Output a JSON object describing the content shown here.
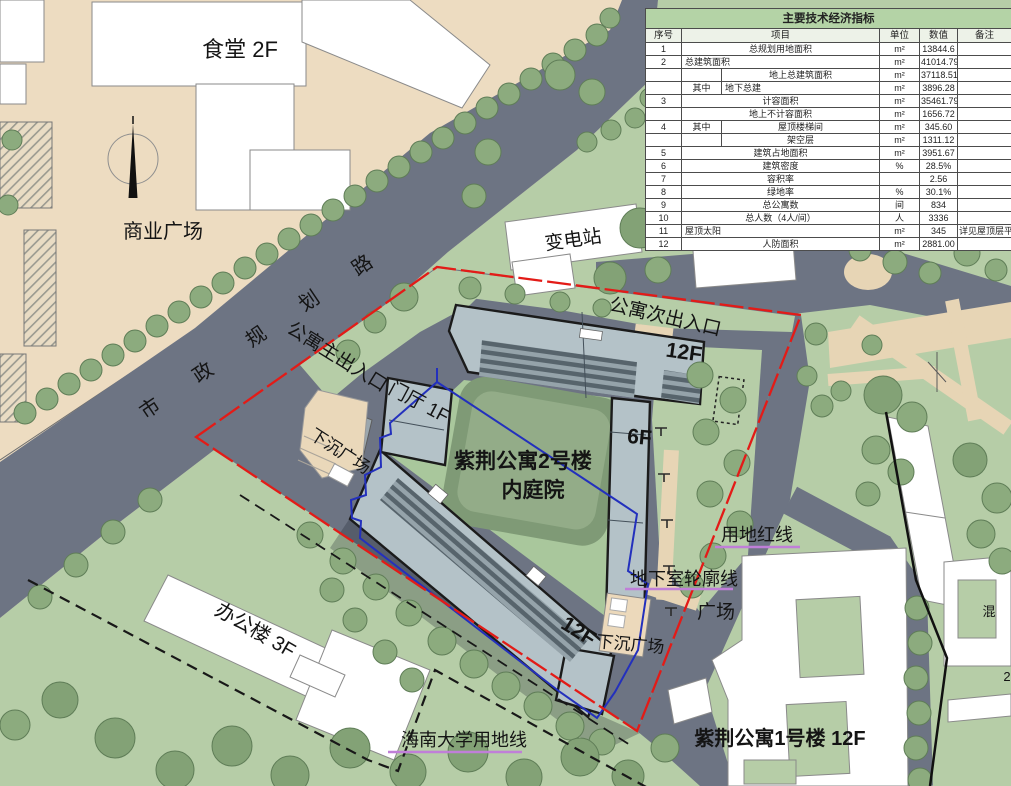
{
  "table": {
    "title": "主要技术经济指标",
    "columns": [
      "序号",
      "项目",
      "单位",
      "数值",
      "备注"
    ],
    "col_widths": [
      36,
      40,
      158,
      40,
      38,
      54
    ],
    "rows": [
      [
        "1",
        {
          "t": "总规划用地面积",
          "cs": 2
        },
        "m²",
        "13844.6",
        ""
      ],
      [
        "2",
        {
          "t": "总建筑面积",
          "cs": 2,
          "al": "l"
        },
        "m²",
        "41014.79",
        ""
      ],
      [
        "",
        "",
        "地上总建筑面积",
        "m²",
        "37118.51",
        ""
      ],
      [
        "",
        "其中",
        {
          "t": "地下总建",
          "al": "l"
        },
        "m²",
        "3896.28",
        ""
      ],
      [
        "3",
        {
          "t": "计容面积",
          "cs": 2
        },
        "m²",
        "35461.79",
        ""
      ],
      [
        "",
        {
          "t": "地上不计容面积",
          "cs": 2
        },
        "m²",
        "1656.72",
        ""
      ],
      [
        "4",
        "其中",
        "屋顶楼梯间",
        "m²",
        "345.60",
        ""
      ],
      [
        "",
        "",
        "架空层",
        "m²",
        "1311.12",
        ""
      ],
      [
        "5",
        {
          "t": "建筑占地面积",
          "cs": 2
        },
        "m²",
        "3951.67",
        ""
      ],
      [
        "6",
        {
          "t": "建筑密度",
          "cs": 2
        },
        "%",
        "28.5%",
        ""
      ],
      [
        "7",
        {
          "t": "容积率",
          "cs": 2
        },
        "",
        "2.56",
        ""
      ],
      [
        "8",
        {
          "t": "绿地率",
          "cs": 2
        },
        "%",
        "30.1%",
        ""
      ],
      [
        "9",
        {
          "t": "总公寓数",
          "cs": 2
        },
        "间",
        "834",
        ""
      ],
      [
        "10",
        {
          "t": "总人数（4人/间）",
          "cs": 2
        },
        "人",
        "3336",
        ""
      ],
      [
        "11",
        {
          "t": "屋顶太阳",
          "cs": 2,
          "al": "l"
        },
        "m²",
        "345",
        "详见屋顶层平面图"
      ],
      [
        "12",
        {
          "t": "人防面积",
          "cs": 2
        },
        "m²",
        "2881.00",
        ""
      ]
    ]
  },
  "labels": [
    {
      "id": "canteen",
      "t": "食堂 2F",
      "x": 240,
      "y": 57,
      "s": 22
    },
    {
      "id": "commercial-plaza",
      "t": "商业广场",
      "x": 163,
      "y": 238,
      "s": 20
    },
    {
      "id": "substation",
      "t": "变电站",
      "x": 574,
      "y": 246,
      "r": -8,
      "s": 19
    },
    {
      "id": "road-name",
      "t": "市政规划路",
      "x": 278,
      "y": 330,
      "r": -34,
      "s": 20,
      "ls": 44
    },
    {
      "id": "main-entrance",
      "t": "公寓主出入口",
      "x": 334,
      "y": 362,
      "r": 32,
      "s": 19
    },
    {
      "id": "lobby",
      "t": "门厅 1F",
      "x": 416,
      "y": 408,
      "r": 28,
      "s": 19
    },
    {
      "id": "sunken-plaza-west",
      "t": "下沉广场",
      "x": 337,
      "y": 456,
      "r": 33,
      "s": 17
    },
    {
      "id": "secondary-entrance",
      "t": "公寓次出入口",
      "x": 664,
      "y": 323,
      "r": 13,
      "s": 19
    },
    {
      "id": "floors-12f-ne",
      "t": "12F",
      "x": 683,
      "y": 359,
      "r": 8,
      "s": 21,
      "w": 600
    },
    {
      "id": "floors-6f",
      "t": "6F",
      "x": 639,
      "y": 444,
      "r": 5,
      "s": 21,
      "w": 600
    },
    {
      "id": "building2-name",
      "t": "紫荆公寓2号楼",
      "x": 523,
      "y": 468,
      "s": 21,
      "w": 600
    },
    {
      "id": "building2-courtyard",
      "t": "内庭院",
      "x": 533,
      "y": 497,
      "s": 21,
      "w": 600
    },
    {
      "id": "floors-12f-se",
      "t": "12F",
      "x": 575,
      "y": 637,
      "r": 32,
      "s": 21,
      "w": 600
    },
    {
      "id": "sunken-plaza-se",
      "t": "下沉广场",
      "x": 630,
      "y": 650,
      "r": 5,
      "s": 17
    },
    {
      "id": "red-line-label",
      "t": "用地红线",
      "x": 757,
      "y": 541,
      "s": 18
    },
    {
      "id": "basement-outline-label",
      "t": "地下室轮廓线",
      "x": 684,
      "y": 585,
      "s": 18
    },
    {
      "id": "plaza-label",
      "t": "广场",
      "x": 716,
      "y": 618,
      "s": 19
    },
    {
      "id": "office-building",
      "t": "办公楼 3F",
      "x": 252,
      "y": 636,
      "r": 30,
      "s": 20
    },
    {
      "id": "university-line-label",
      "t": "海南大学用地线",
      "x": 464,
      "y": 746,
      "s": 18
    },
    {
      "id": "building1-name",
      "t": "紫荆公寓1号楼 12F",
      "x": 780,
      "y": 745,
      "s": 20,
      "w": 600
    },
    {
      "id": "partial-label-hun",
      "t": "混",
      "x": 989,
      "y": 616,
      "s": 13
    },
    {
      "id": "partial-label-2",
      "t": "2",
      "x": 1007,
      "y": 681,
      "s": 13
    }
  ],
  "colors": {
    "background_green": "#b6cda7",
    "road_grey": "#6d7483",
    "plaza_beige": "#eddcc1",
    "path_tan": "#e7d5b5",
    "building_grey": "#b4c2c8",
    "tree_green": "#8cab7e",
    "courtyard_green": "#a9c79c",
    "red_line": "#e31b17",
    "blue_line": "#2330bd",
    "purple_leader": "#c07fd8",
    "table_title_green": "#b4d3a6"
  }
}
